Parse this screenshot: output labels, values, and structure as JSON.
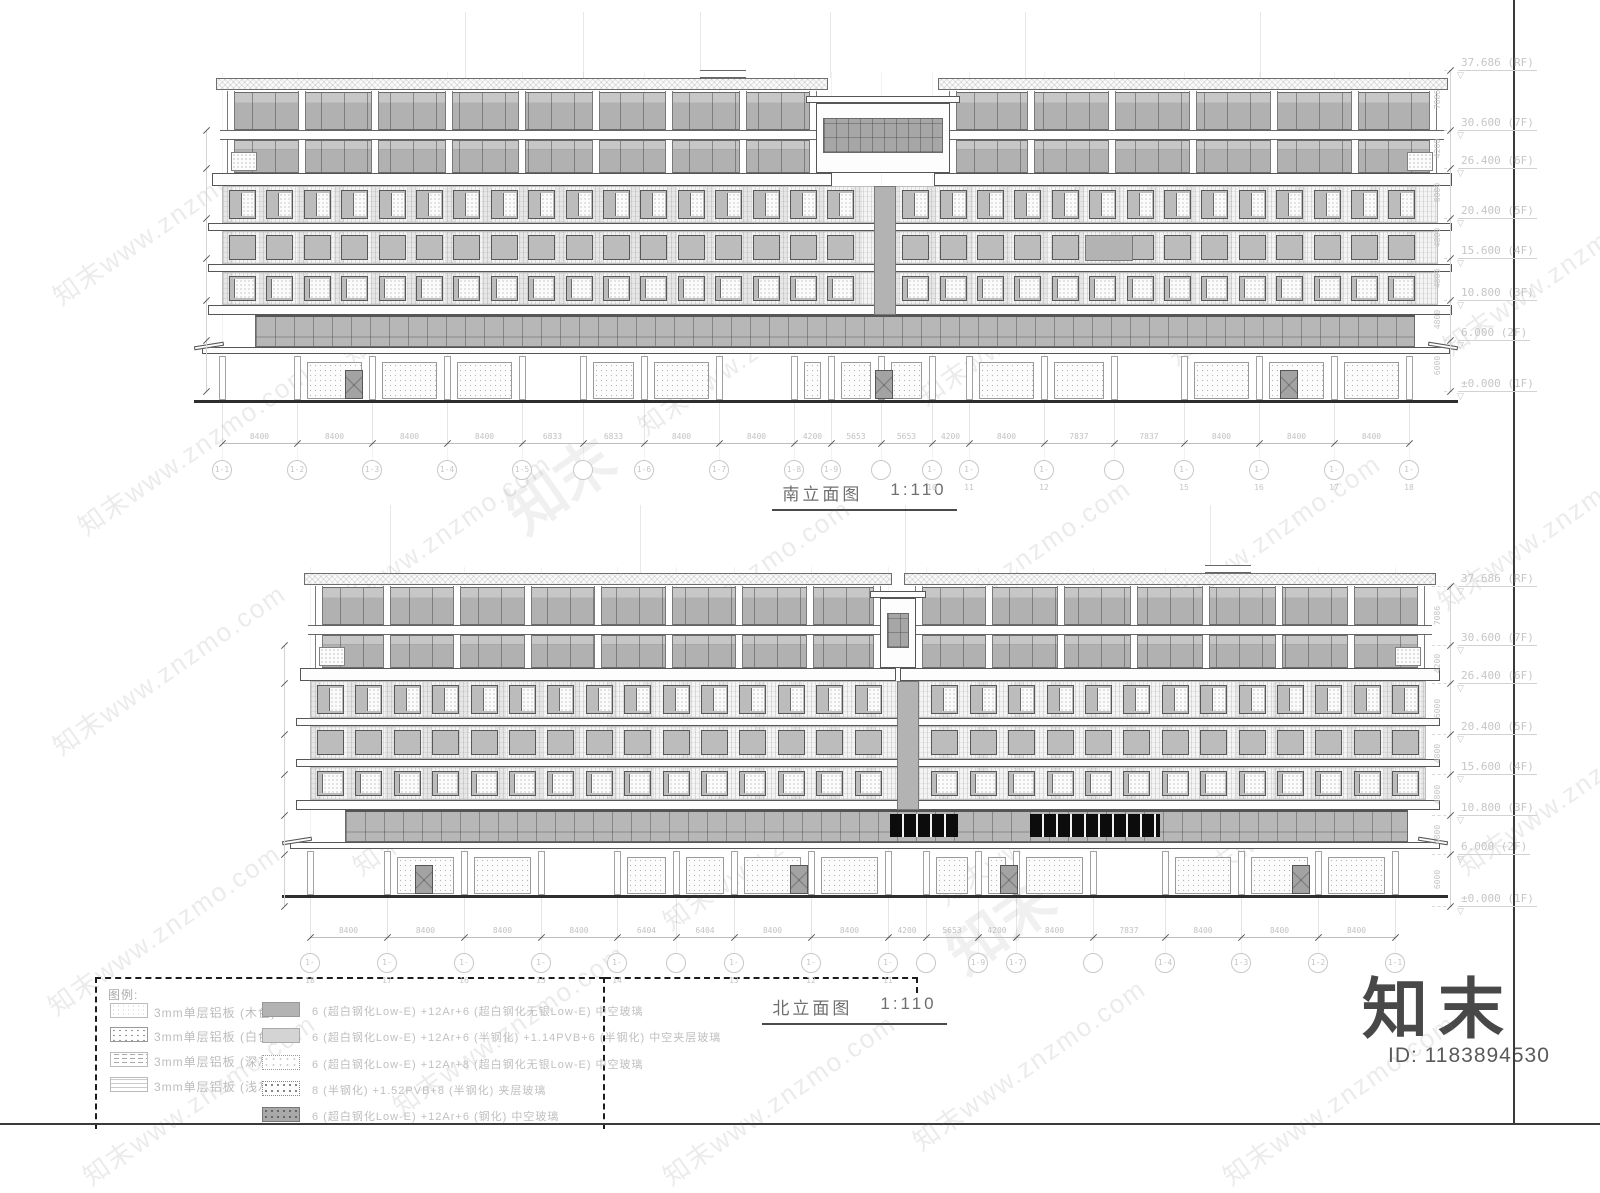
{
  "watermark": {
    "text": "知末www.znzmo.com",
    "brand": "知末"
  },
  "footer": {
    "brand": "知末",
    "id": "ID: 1183894530"
  },
  "levels": [
    [
      "37.686",
      "(RF)"
    ],
    [
      "30.600",
      "(7F)"
    ],
    [
      "26.400",
      "(6F)"
    ],
    [
      "20.400",
      "(5F)"
    ],
    [
      "15.600",
      "(4F)"
    ],
    [
      "10.800",
      "(3F)"
    ],
    [
      "6.000",
      "(2F)"
    ],
    [
      "±0.000",
      "(1F)"
    ]
  ],
  "vertical_dims": [
    "7086",
    "4200",
    "6000",
    "4800",
    "4800",
    "4800",
    "6000"
  ],
  "south": {
    "title": "南立面图",
    "scale": "1:110",
    "dims": [
      "8400",
      "8400",
      "8400",
      "8400",
      "6833",
      "6833",
      "8400",
      "8400",
      "4200",
      "5653",
      "5653",
      "4200",
      "8400",
      "7837",
      "7837",
      "8400",
      "8400",
      "8400"
    ],
    "bubbles": [
      "1-1",
      "1-2",
      "1-3",
      "1-4",
      "1-5",
      "",
      "1-6",
      "1-7",
      "1-8",
      "1-9",
      "",
      "1-10",
      "1-11",
      "1-12",
      "",
      "1-15",
      "1-16",
      "1-17",
      "1-18"
    ]
  },
  "north": {
    "title": "北立面图",
    "scale": "1:110",
    "dims": [
      "8400",
      "8400",
      "8400",
      "8400",
      "6404",
      "6404",
      "8400",
      "8400",
      "4200",
      "5653",
      "4200",
      "8400",
      "7837",
      "8400",
      "8400",
      "8400"
    ],
    "bubbles": [
      "1-18",
      "1-17",
      "1-16",
      "1-15",
      "1-14",
      "",
      "1-13",
      "1-12",
      "1-11",
      "",
      "1-9",
      "1-7",
      "",
      "1-4",
      "1-3",
      "1-2",
      "1-1"
    ]
  },
  "legend": {
    "heading": "图例:",
    "panels": [
      {
        "pattern": "dots-sparse",
        "label": "3mm单层铝板 (木色)"
      },
      {
        "pattern": "dots-grid",
        "label": "3mm单层铝板 (白色)"
      },
      {
        "pattern": "dash-lines",
        "label": "3mm单层铝板 (深灰色)"
      },
      {
        "pattern": "h-lines",
        "label": "3mm单层铝板 (浅灰色)"
      }
    ],
    "glass": [
      {
        "pattern": "solid-gray",
        "label": "6 (超白钢化Low-E) +12Ar+6 (超白钢化无银Low-E) 中空玻璃"
      },
      {
        "pattern": "solid-light",
        "label": "6 (超白钢化Low-E) +12Ar+6 (半钢化) +1.14PVB+6 (半钢化) 中空夹层玻璃"
      },
      {
        "pattern": "stipple",
        "label": "6 (超白钢化Low-E) +12Ar+8 (超白钢化无银Low-E) 中空玻璃"
      },
      {
        "pattern": "stipple-dense",
        "label": "8 (半钢化) +1.52PVB+8 (半钢化) 夹层玻璃"
      },
      {
        "pattern": "stipple-dark",
        "label": "6 (超白钢化Low-E) +12Ar+6 (钢化) 中空玻璃"
      }
    ]
  },
  "colors": {
    "line": "#444444",
    "faint_text": "#c4c4c4",
    "glass": "#b4b4b4",
    "black_panel": "#0c0c0c"
  }
}
